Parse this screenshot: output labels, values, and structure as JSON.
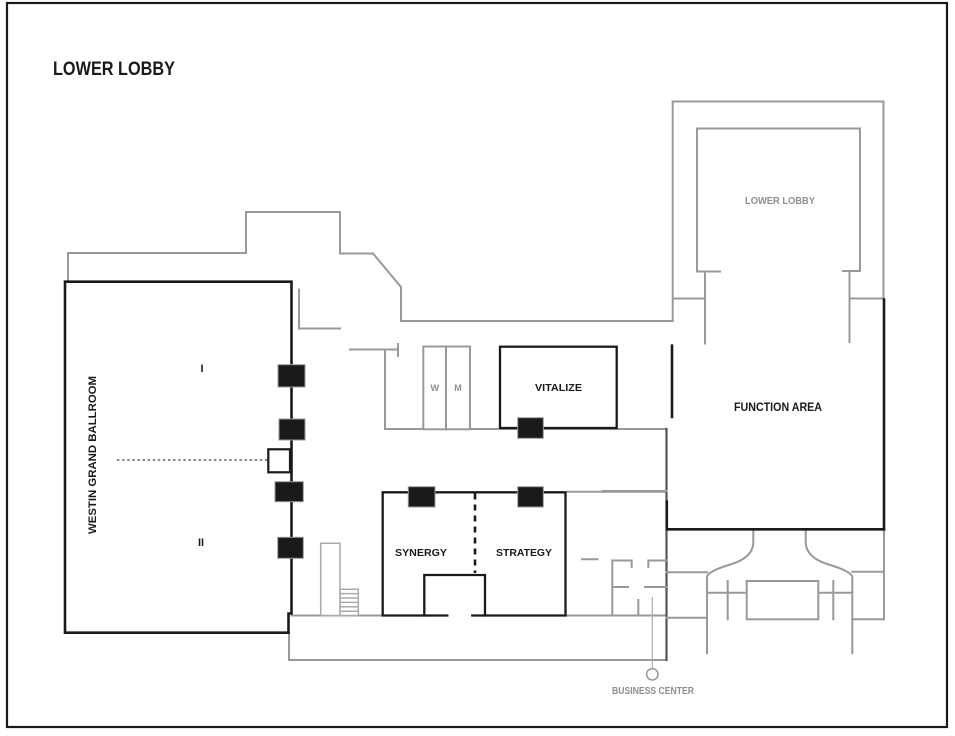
{
  "title": "LOWER LOBBY",
  "colors": {
    "wall_black": "#1a1a1a",
    "wall_gray": "#999999",
    "text_gray": "#8f8f8f",
    "background": "#ffffff"
  },
  "rooms": {
    "ballroom": {
      "label": "WESTIN GRAND BALLROOM",
      "section_i": "I",
      "section_ii": "II"
    },
    "lower_lobby": {
      "label": "LOWER LOBBY"
    },
    "function_area": {
      "label": "FUNCTION AREA"
    },
    "vitalize": {
      "label": "VITALIZE"
    },
    "synergy": {
      "label": "SYNERGY"
    },
    "strategy": {
      "label": "STRATEGY"
    },
    "restrooms": {
      "women": "W",
      "men": "M"
    },
    "business_center": {
      "label": "BUSINESS CENTER"
    }
  }
}
